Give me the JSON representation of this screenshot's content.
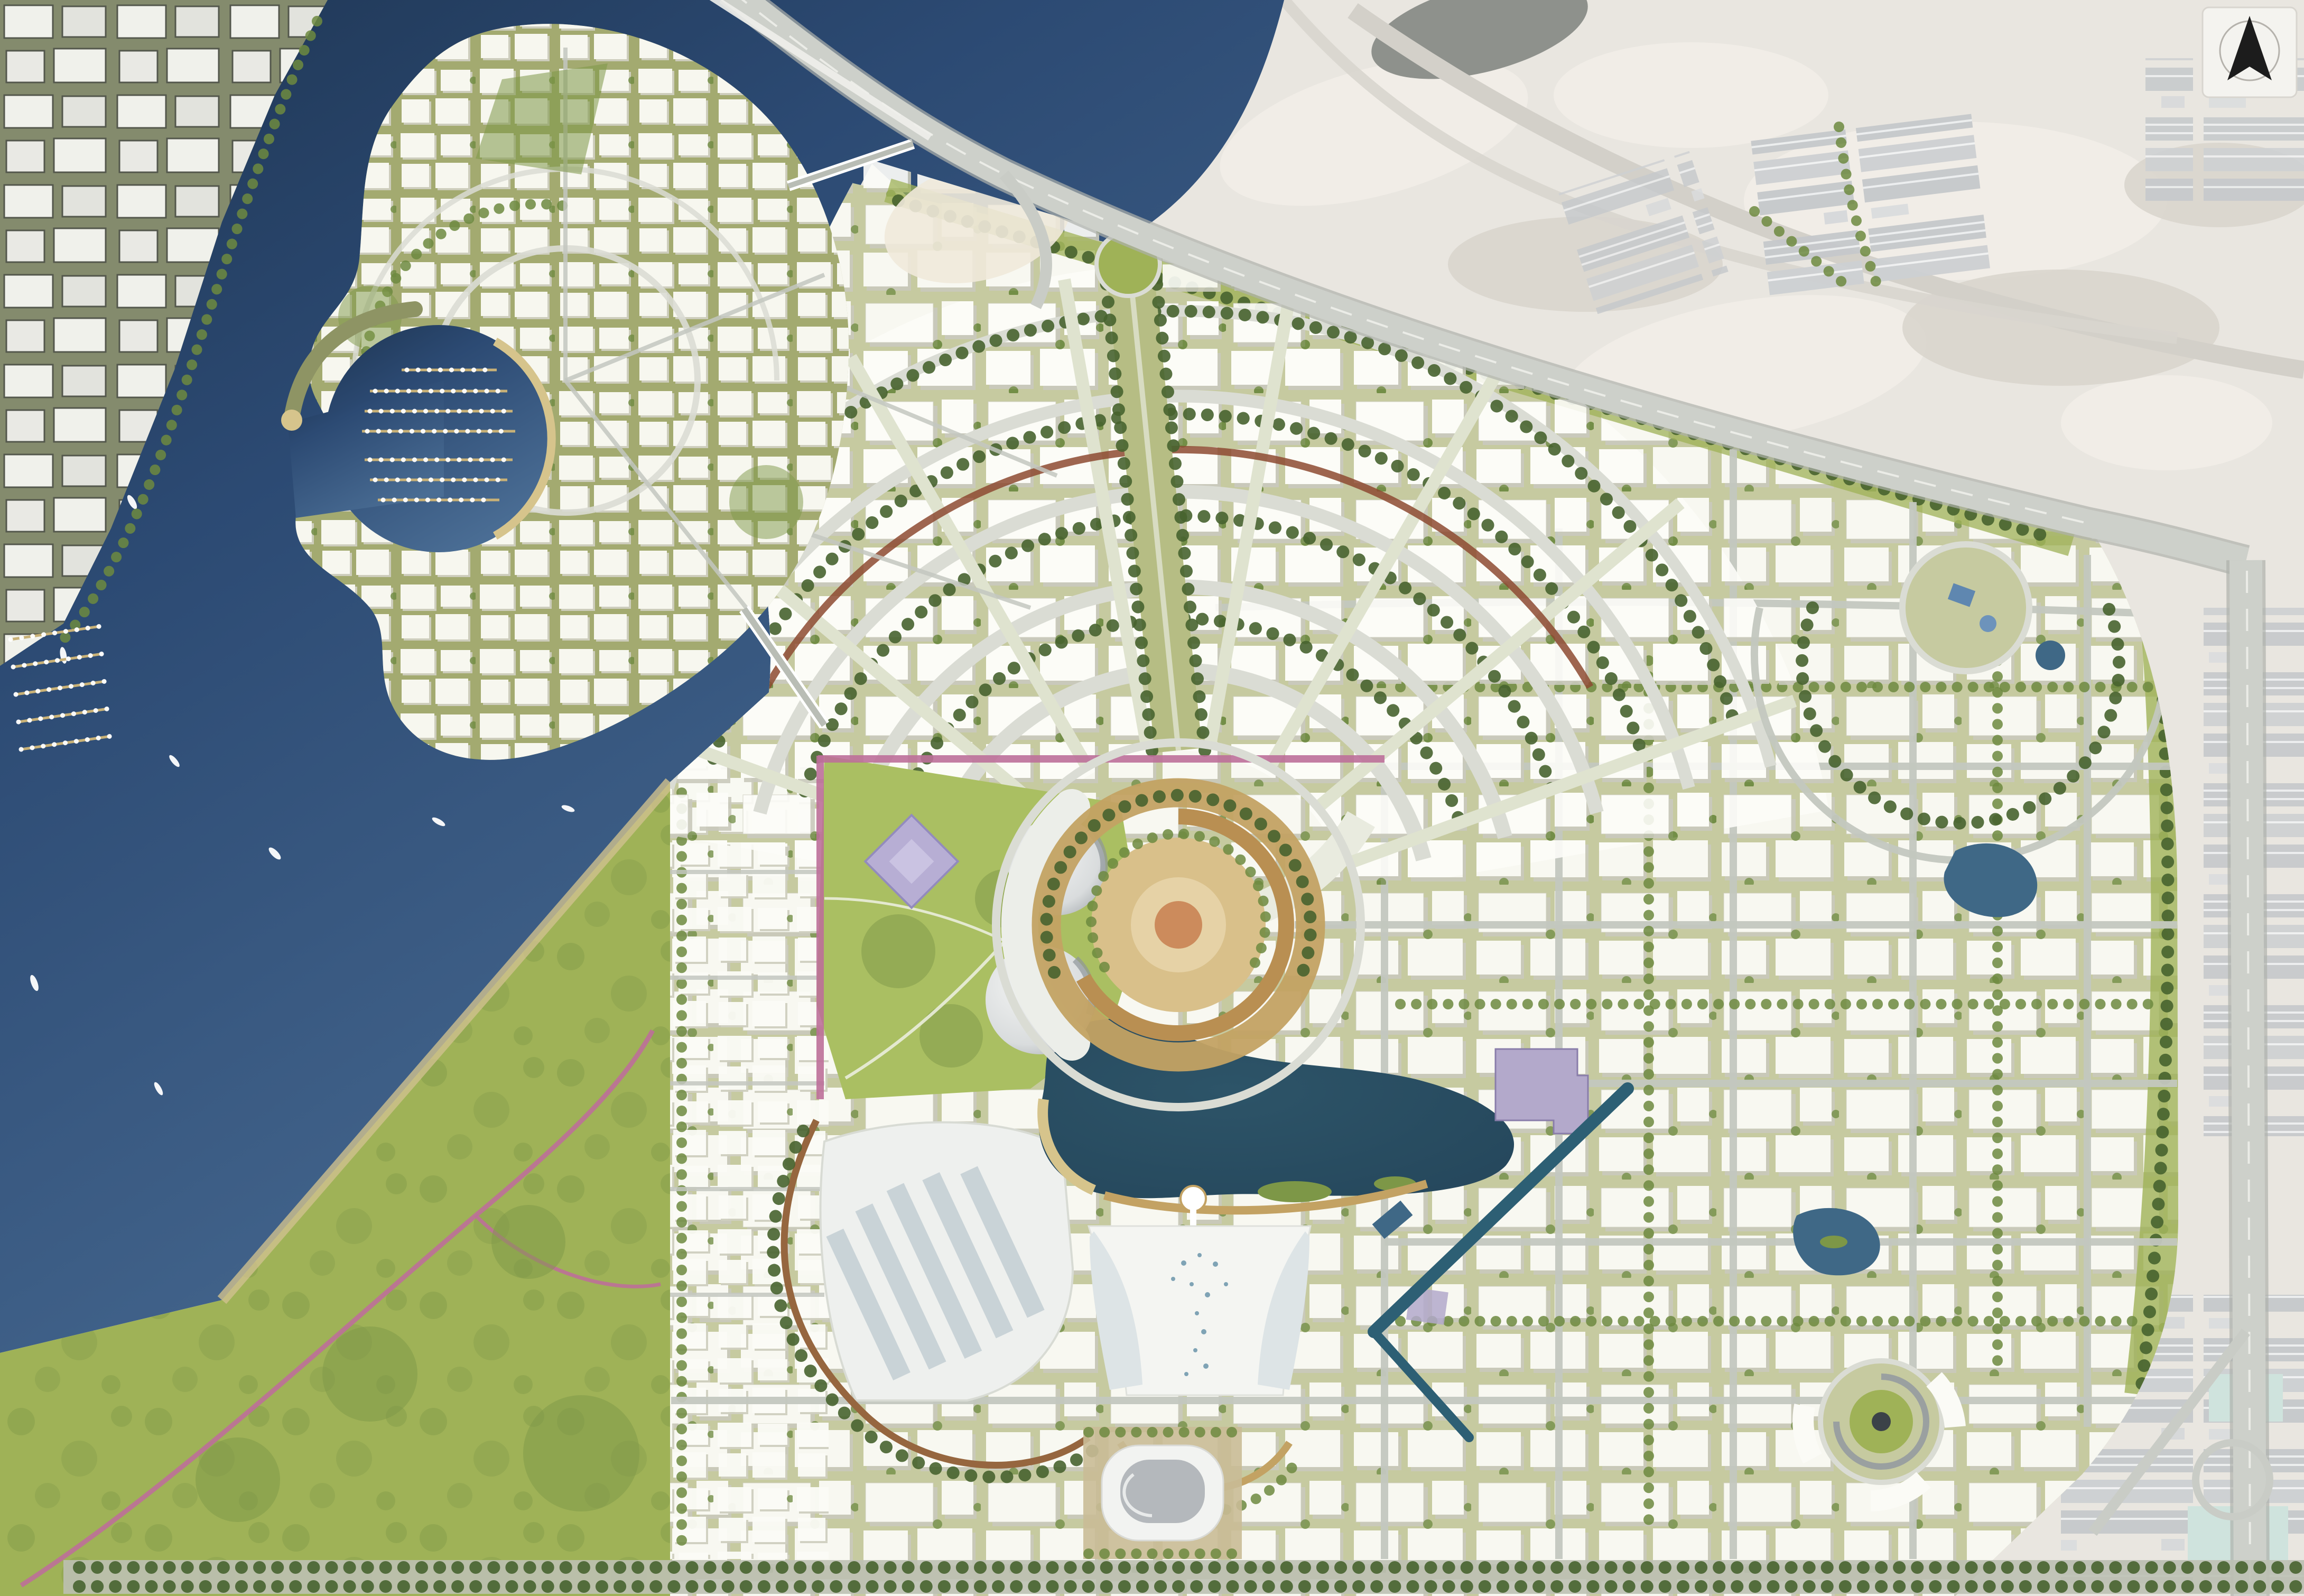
{
  "meta": {
    "description": "Top-down aerial rendering of a waterfront urban master plan: marina island in a steel-blue creek, fan-shaped radial city around a golden landmark tower plaza, central lake with canopy complex and stadium, large green sanctuary park south-west, pale desert and industrial context north-east, highway corridors and a north arrow.",
    "view": "satellite-style masterplan illustration",
    "visible_text_labels": []
  },
  "north_arrow": {
    "icon": "north-arrow-icon",
    "glyph": "black kite-shaped arrowhead inside faint circle on white plate",
    "position": "top-right corner"
  },
  "features": {
    "sea_creek": "deep steel-blue water body on left and top-centre, crossed by a highway bridge",
    "marina_island": "oval island with concentric streets, circular marina basin, jetties with moored boats, breakwater spit, two bridges to mainland",
    "existing_city_strip": "outlined white city blocks with small marina at top-left shore",
    "sanctuary_park": "large olive-green park with winding pink trail filling bottom-left",
    "radial_fan_district": "fan of concentric arc streets and radial spokes north of the tower plaza",
    "tower_plaza": "golden oval spiral plaza of the landmark tower with white swoosh podium",
    "dome_venues": "two silver-white dome buildings west of the plaza",
    "central_park_wedge": "rolling green park with tree clusters, white paths and lavender faceted pavilion",
    "lake": "dark teal lake with beach crescent, islets and small white pier",
    "canopy_complex": "white canopy retail complex with glass fans south of the lake",
    "stadium": "arena with rounded-square white ring roof and grey bowl at bottom centre",
    "glass_retail_complex": "glass-roofed complex with brown crescent boulevard west of the lake",
    "purple_blocks": "lavender cultural building blocks east of the lake",
    "canal": "teal canal cutting diagonally through the south-east district",
    "ne_ponds_nodes": "curvilinear north-east district with blue ponds and circular nodes",
    "spiral_node": "spiral plaza with green centre and curved white buildings at south-east",
    "highways": "grey highway crossing the creek along the plan's north edge plus vertical corridor on right edge",
    "desert_context": "washed-out sand with warehouse clusters, roads and dark pond at top-right",
    "bottom_boulevard": "double tree row boulevard along bottom edge",
    "green_buffers": "tree-lined green edges framing the master plan"
  },
  "counts": {
    "fan_arc_streets": 5,
    "fan_radial_spokes": 8,
    "marina_jetty_rows": 7,
    "city_marina_jetties": 5,
    "sea_boats": 12,
    "dome_venues": 2,
    "purple_blocks": 2,
    "bridges": 3
  },
  "colors": {
    "water": "#4a6d94",
    "water_deep": "#2c4a73",
    "creek_dark": "#1e3552",
    "park": "#9fb257",
    "park_dark": "#7d9747",
    "park_light": "#aabf62",
    "desert": "#e9e6e0",
    "desert_shadow": "#d8d4cb",
    "sand_light": "#f2efe9",
    "plan_ground": "#c6caa0",
    "island_ground": "#a3aa70",
    "block_white": "#fcfcf8",
    "block_shadow": "#d6d6c8",
    "tree_dark": "#47632f",
    "tree_mid": "#6d8a40",
    "road": "#c3c7bf",
    "road_light": "#dadcd4",
    "highway": "#cdd0ca",
    "highway_edge": "#aeb1ab",
    "gold": "#c3a263",
    "beach": "#d6c48c",
    "lake": "#2d5468",
    "lake_deep": "#24455a",
    "canal": "#2d5f74",
    "pond": "#3f6886",
    "pond_gray": "#8e918c",
    "purple": "#b3a9cb",
    "purple_dark": "#897daa",
    "lavender": "#b7aed4",
    "maroon": "#8d4a31",
    "pink": "#bc6f99",
    "glass": "#c5d0d5",
    "glass_light": "#dde4e6",
    "dome_hi": "#f3f4f3",
    "dome_lo": "#a8adb1",
    "city_ground": "#848b6d",
    "city_outline": "#50544a",
    "stadium_bowl": "#b4b8bc",
    "stadium_rim": "#f2f3f1",
    "plaza_tan": "#c9bb96",
    "jetty": "#c8b177",
    "warehouse": "#c5c8cb",
    "teal_roof": "#cfe3dd",
    "arrow_black": "#1c1c1c",
    "plate": "#f4f3ef",
    "plate_edge": "#d8d5cf"
  }
}
